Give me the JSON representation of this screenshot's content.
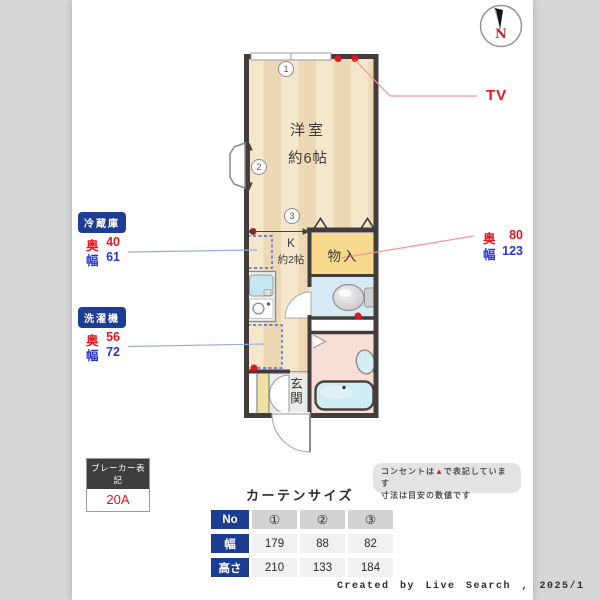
{
  "compass": {
    "north": "N"
  },
  "rooms": {
    "western_room": {
      "name": "洋室",
      "size": "約6帖"
    },
    "kitchen": {
      "name": "K",
      "size": "約2帖"
    },
    "storage": {
      "name": "物入"
    },
    "entrance": {
      "name": "玄関"
    }
  },
  "markers": {
    "m1": "1",
    "m2": "2",
    "m3": "3"
  },
  "callouts": {
    "tv": "TV",
    "storage_dims": {
      "depth_label": "奥",
      "depth": "80",
      "width_label": "幅",
      "width": "123"
    },
    "fridge": {
      "title": "冷蔵庫",
      "depth_label": "奥",
      "depth": "40",
      "width_label": "幅",
      "width": "61"
    },
    "washer": {
      "title": "洗濯機",
      "depth_label": "奥",
      "depth": "56",
      "width_label": "幅",
      "width": "72"
    }
  },
  "breaker": {
    "title": "ブレーカー表記",
    "value": "20A"
  },
  "note": {
    "line1_pre": "コンセントは",
    "marker": "▲",
    "line1_post": "で表記しています",
    "line2": "寸法は目安の数値です"
  },
  "curtain_table": {
    "title": "カーテンサイズ",
    "rows": [
      {
        "header": "No",
        "cells": [
          "①",
          "②",
          "③"
        ]
      },
      {
        "header": "幅",
        "cells": [
          "179",
          "88",
          "82"
        ]
      },
      {
        "header": "高さ",
        "cells": [
          "210",
          "133",
          "184"
        ]
      }
    ]
  },
  "footer": {
    "credit": "Created by Live Search , 2025/1"
  },
  "colors": {
    "accent_navy": "#1d3d94",
    "red": "#e8131e",
    "blue": "#2636cf",
    "wall": "#423c3a"
  }
}
